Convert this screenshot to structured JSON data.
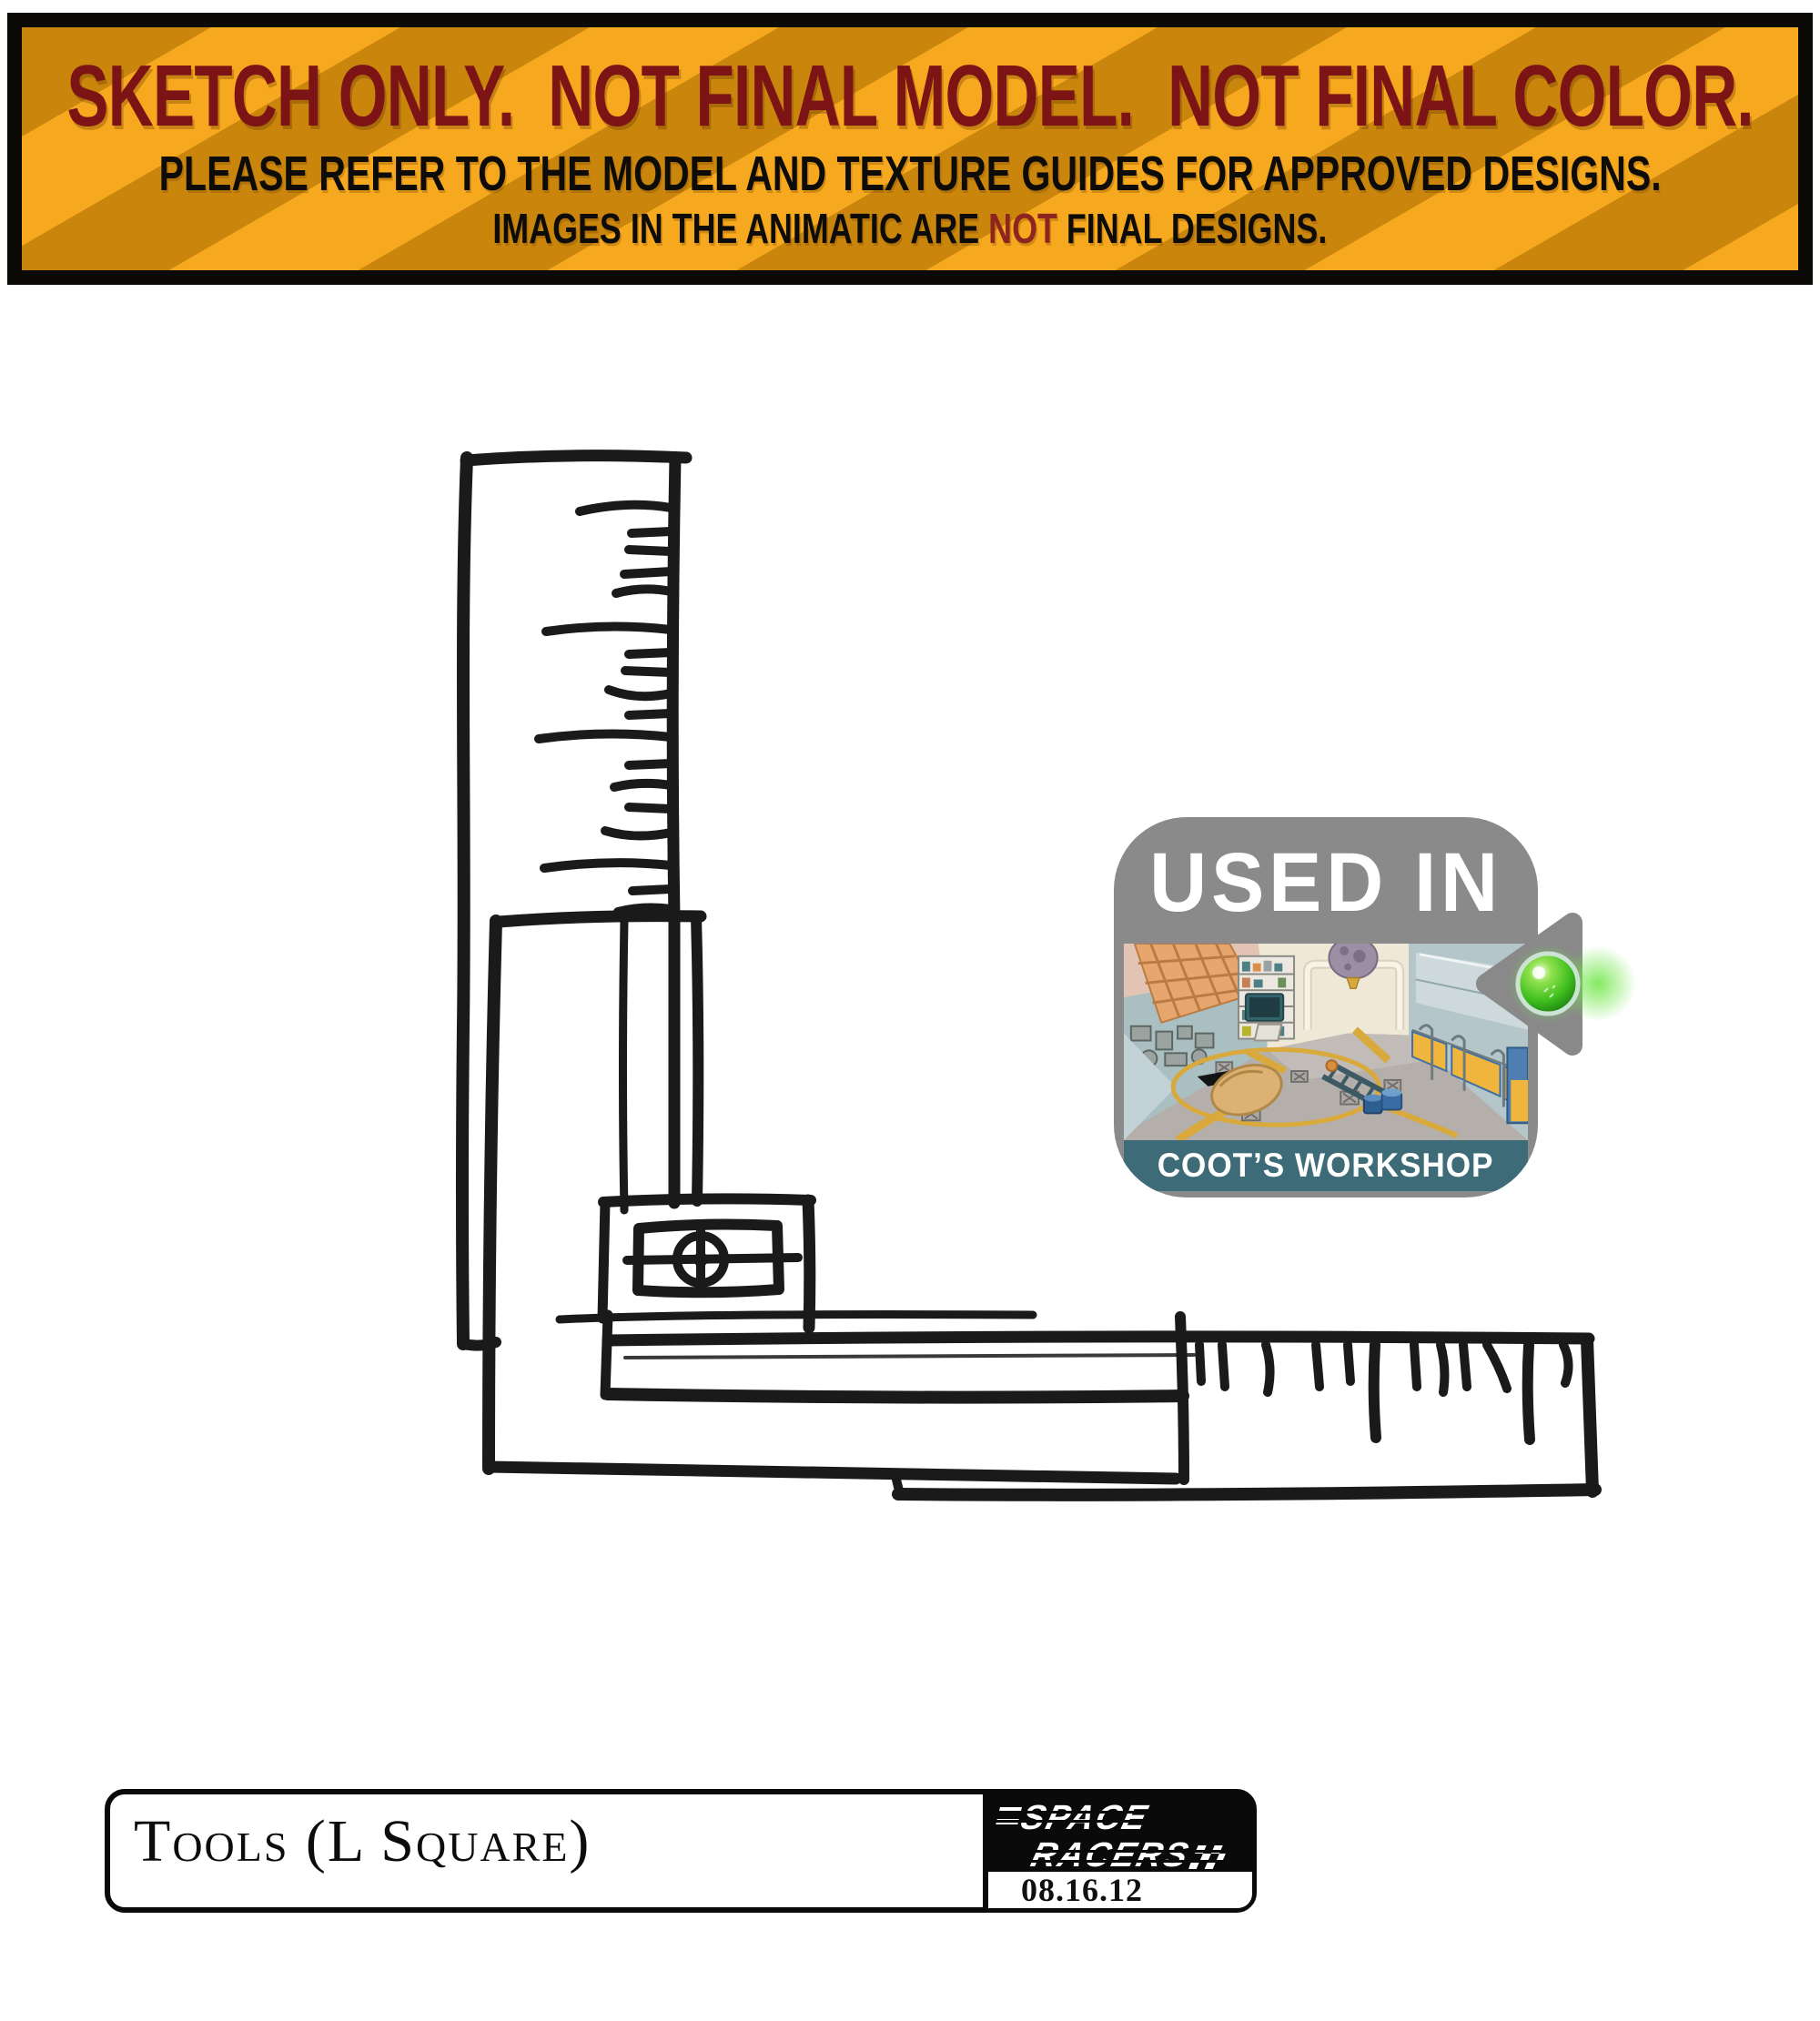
{
  "banner": {
    "line1": "SKETCH ONLY.  NOT FINAL MODEL.  NOT FINAL COLOR.",
    "line2": "PLEASE REFER TO THE MODEL AND TEXTURE GUIDES FOR APPROVED DESIGNS.",
    "line3_before": "IMAGES IN THE ANIMATIC ARE ",
    "line3_not": "NOT",
    "line3_after": " FINAL DESIGNS.",
    "colors": {
      "stripe_bright": "#F6A81E",
      "stripe_dark": "#C9850C",
      "warning_red": "#7C1315",
      "not_red": "#8E2420",
      "frame_black": "#0B0A07"
    }
  },
  "badge": {
    "title": "USED IN",
    "caption": "COOT’S WORKSHOP",
    "colors": {
      "badge_gray": "#8A8A8A",
      "band_teal": "#3D6B77",
      "orb_green": "#3FBF1F"
    }
  },
  "sketch": {
    "subject": "hand-drawn L square ruler with tick marks and center fitting"
  },
  "title_block": {
    "title": "Tools (L Square)"
  },
  "logo": {
    "line1": "SPACE",
    "line2": "RACERS",
    "date": "08.16.12",
    "background": "#0A0A0A"
  }
}
